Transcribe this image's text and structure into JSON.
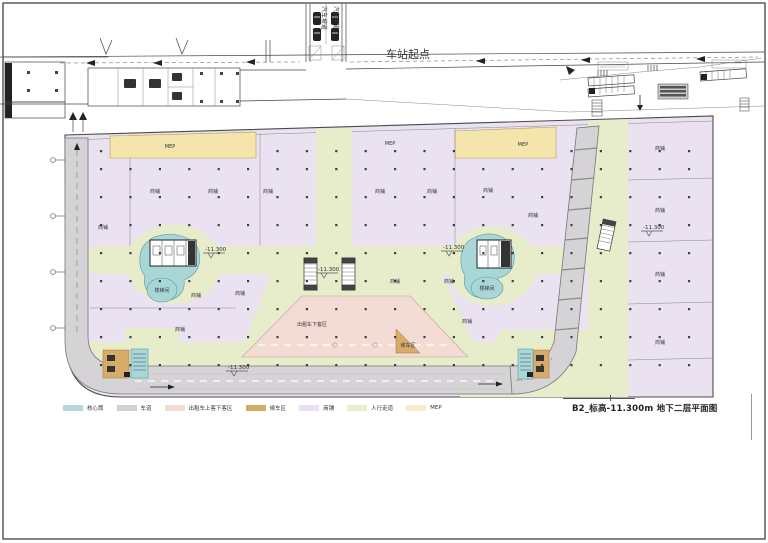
{
  "sheet": {
    "title": "B2_标高-11.300m 地下二层平面图",
    "station_start": "车站起点",
    "ramp_label": "汽车坡道",
    "level_marker": "-11.300"
  },
  "legend": {
    "items": [
      {
        "label": "核心筒",
        "color": "#b7d9d5"
      },
      {
        "label": "车道",
        "color": "#d2d2d4"
      },
      {
        "label": "出租车上客下客区",
        "color": "#f0dcd4"
      },
      {
        "label": "候车区",
        "color": "#d7ab68"
      },
      {
        "label": "商铺",
        "color": "#e8e0f2"
      },
      {
        "label": "人行走道",
        "color": "#e8edcb"
      },
      {
        "label": "MEP",
        "color": "#f4ecc8"
      }
    ]
  },
  "plan": {
    "labels": {
      "shop": "商铺",
      "mep": "MEP",
      "taxi": "出租车下客区",
      "waiting": "候车区",
      "stair": "楼梯间"
    }
  }
}
